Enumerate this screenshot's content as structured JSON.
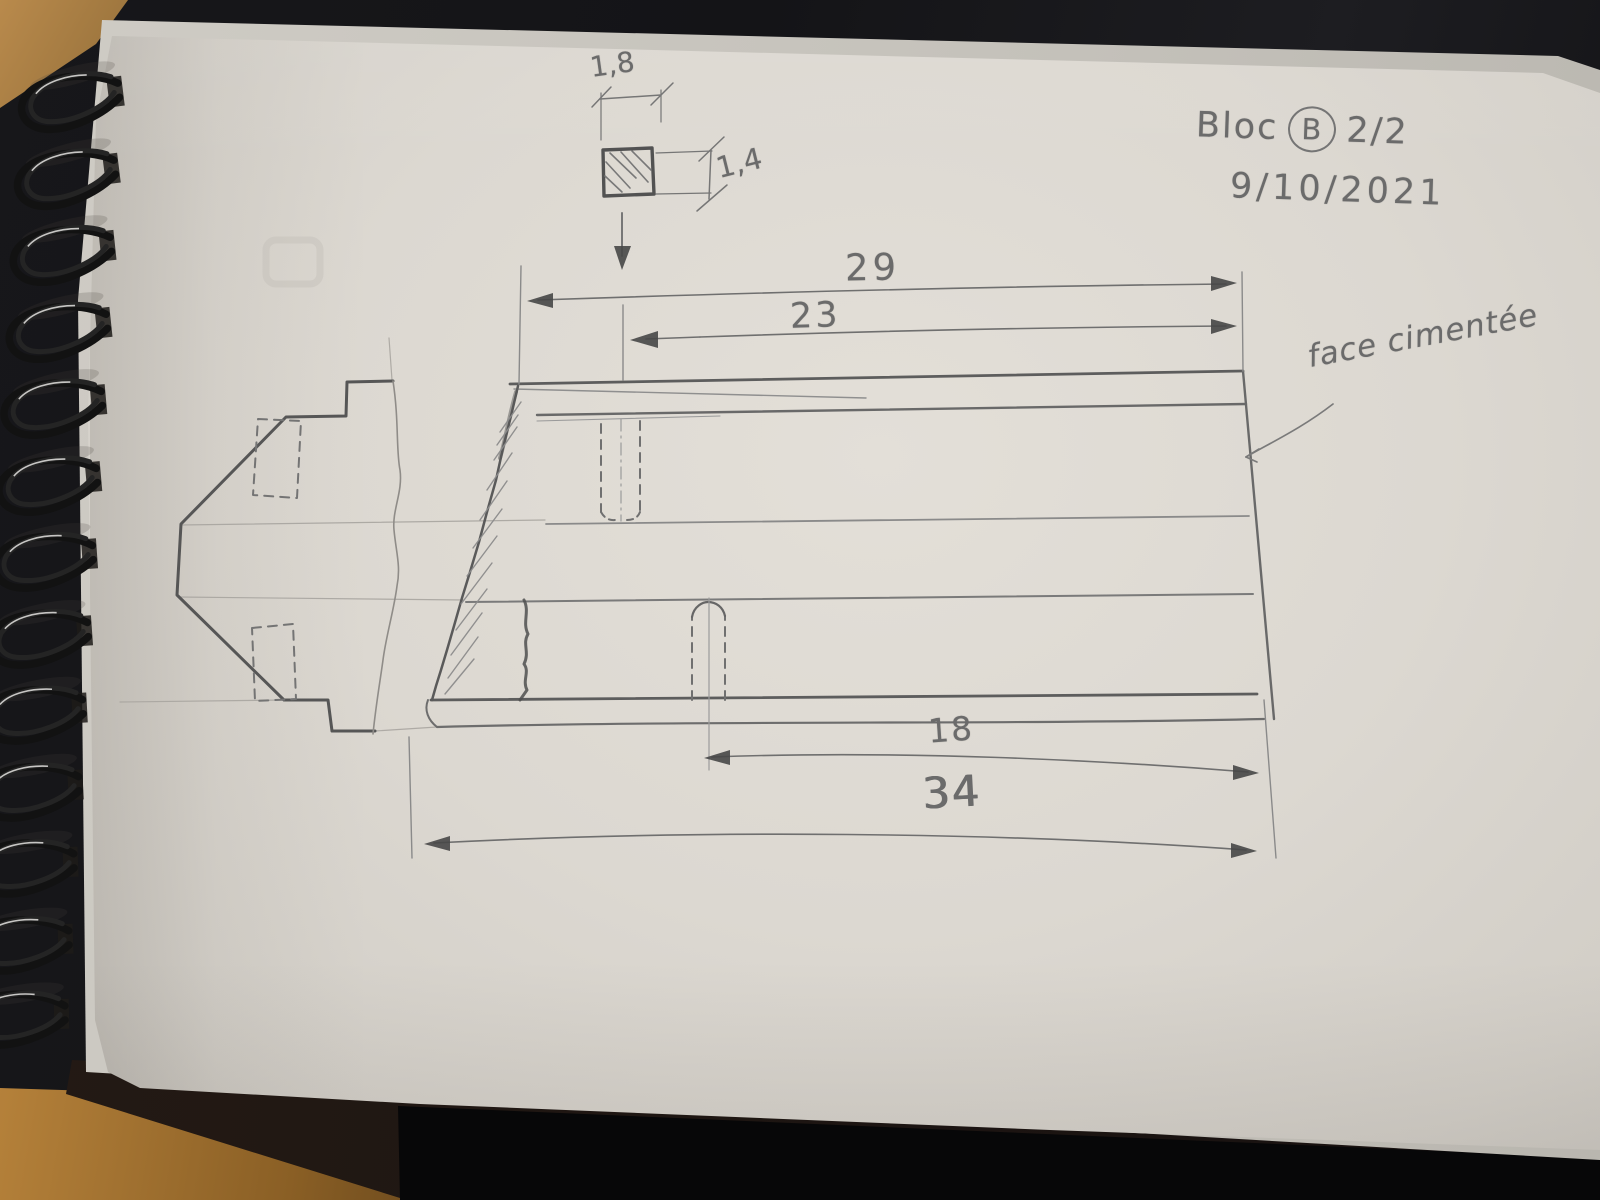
{
  "title_block": {
    "bloc_label": "Bloc",
    "bloc_letter": "B",
    "sheet": "2/2",
    "date": "9/10/2021"
  },
  "notes": {
    "face_note": "face cimentée"
  },
  "dimensions": {
    "overall_length_top": "29",
    "length_to_slot": "23",
    "slot_to_end": "18",
    "overall_length_bottom": "34",
    "square_width": "1,8",
    "square_height": "1,4"
  },
  "colors": {
    "paper": "#dcd8d1",
    "pencil": "#6b6b6b",
    "desk": "#141417",
    "wood": "#a87a3c",
    "wire": "#151515"
  }
}
